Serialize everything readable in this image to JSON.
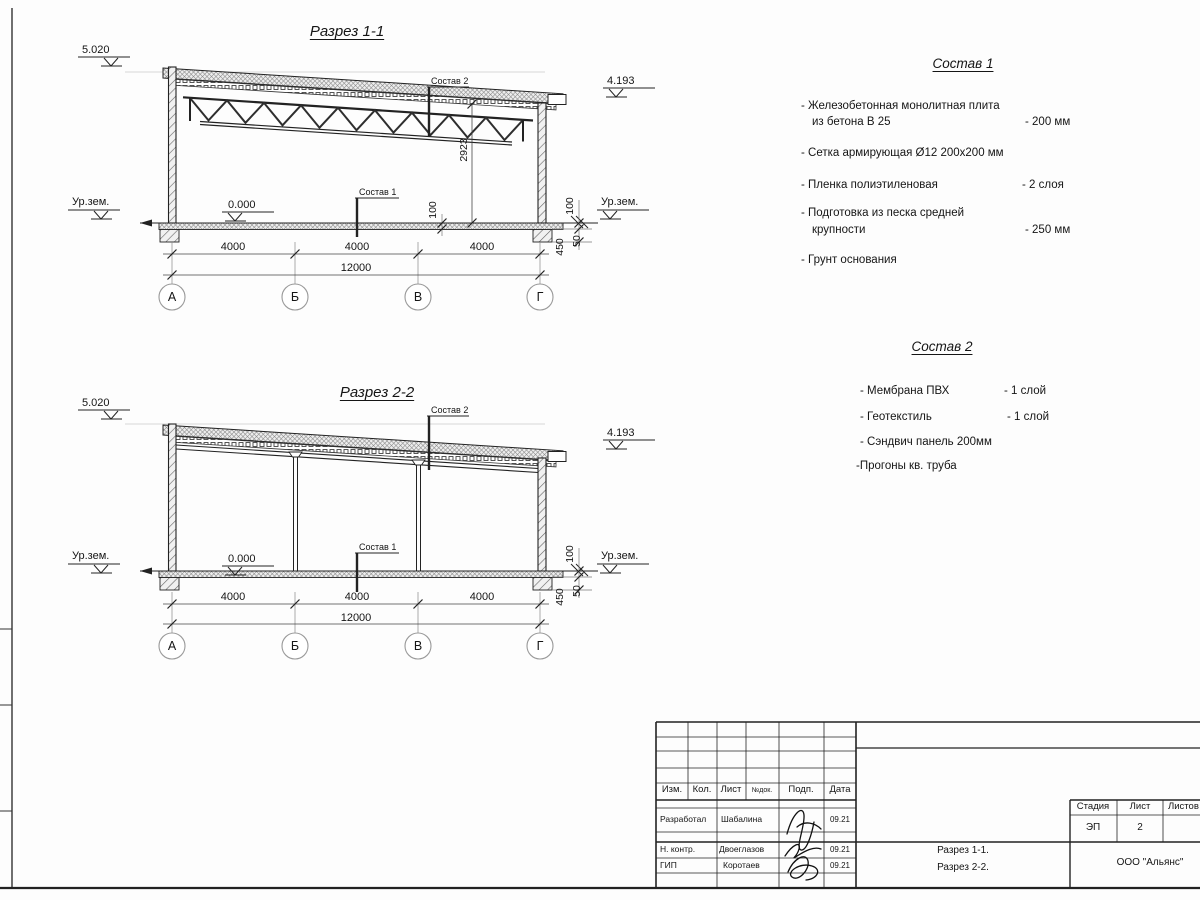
{
  "section1": {
    "title": "Разрез 1-1",
    "level_top": "5.020",
    "level_right": "4.193",
    "ground_left": "Ур.зем.",
    "ground_right": "Ур.зем.",
    "level_zero": "0.000",
    "callout_top": "Состав 2",
    "callout_floor": "Состав 1",
    "dim_height": "2923",
    "dim_floor_thk": "100",
    "dim_r100": "100",
    "dim_r450": "450",
    "dim_r50": "50",
    "spans": [
      "4000",
      "4000",
      "4000"
    ],
    "total": "12000",
    "axes": [
      "А",
      "Б",
      "В",
      "Г"
    ]
  },
  "section2": {
    "title": "Разрез 2-2",
    "level_top": "5.020",
    "level_right": "4.193",
    "ground_left": "Ур.зем.",
    "ground_right": "Ур.зем.",
    "level_zero": "0.000",
    "callout_top": "Состав 2",
    "callout_floor": "Состав 1",
    "dim_r100": "100",
    "dim_r450": "450",
    "dim_r50": "50",
    "spans": [
      "4000",
      "4000",
      "4000"
    ],
    "total": "12000",
    "axes": [
      "А",
      "Б",
      "В",
      "Г"
    ]
  },
  "sostav1": {
    "title": "Состав 1",
    "items": [
      {
        "text": "- Железобетонная  монолитная плита",
        "text2": "из бетона В 25",
        "value": "- 200 мм"
      },
      {
        "text": "- Сетка армирующая Ø12 200х200 мм",
        "text2": "",
        "value": ""
      },
      {
        "text": "- Пленка полиэтиленовая",
        "text2": "",
        "value": "-  2 слоя"
      },
      {
        "text": "- Подготовка из песка средней",
        "text2": "крупности",
        "value": "- 250 мм"
      },
      {
        "text": "- Грунт основания",
        "text2": "",
        "value": ""
      }
    ]
  },
  "sostav2": {
    "title": "Состав 2",
    "items": [
      {
        "text": "- Мембрана ПВХ",
        "value": "- 1 слой"
      },
      {
        "text": "- Геотекстиль",
        "value": "- 1 слой"
      },
      {
        "text": "- Сэндвич панель 200мм",
        "value": ""
      },
      {
        "text": "-Прогоны кв. труба",
        "value": ""
      }
    ]
  },
  "titleblock": {
    "cols": {
      "izm": "Изм.",
      "kol": "Кол.",
      "list": "Лист",
      "ndok": "№док.",
      "podp": "Подп.",
      "data": "Дата"
    },
    "rows": [
      {
        "role": "Разработал",
        "name": "Шабалина",
        "date": "09.21"
      },
      {
        "role": "Н. контр.",
        "name": "Двоеглазов",
        "date": "09.21"
      },
      {
        "role": "ГИП",
        "name": "Коротаев",
        "date": "09.21"
      }
    ],
    "stage_label": "Стадия",
    "sheet_label": "Лист",
    "sheets_label": "Листов",
    "stage": "ЭП",
    "sheet": "2",
    "doc_line1": "Разрез 1-1.",
    "doc_line2": "Разрез 2-2.",
    "company": "ООО \"Альянс\""
  }
}
